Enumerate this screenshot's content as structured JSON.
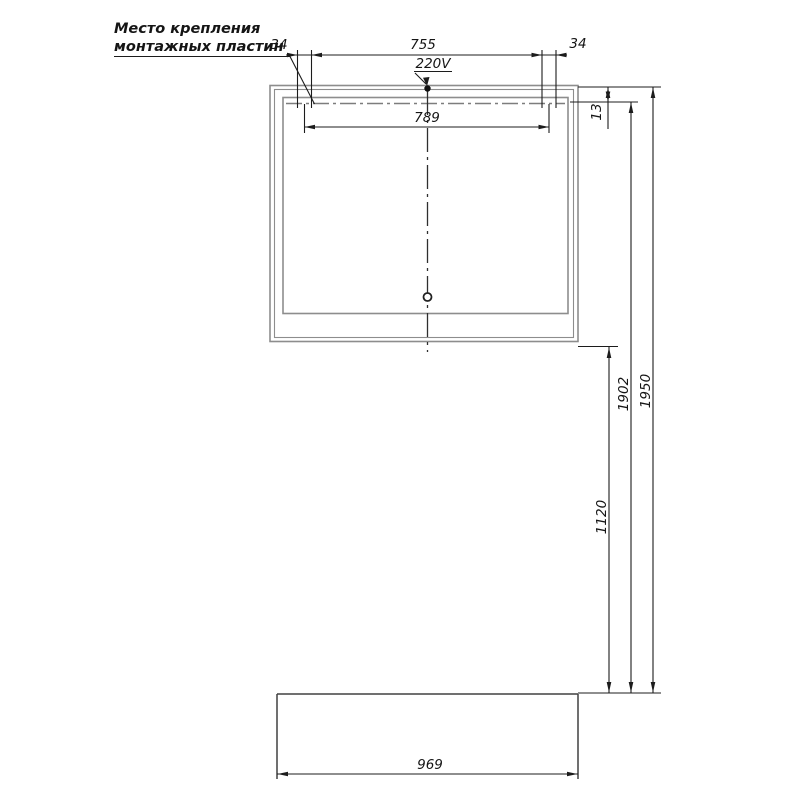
{
  "drawing": {
    "title_semantic": "mirror-installation-dimension-drawing",
    "note": {
      "line1": "Место крепления",
      "line2": "монтажных пластин"
    },
    "dimensions": {
      "plate_width_left": "34",
      "plate_spacing": "755",
      "plate_width_right": "34",
      "power_label": "220V",
      "plate_centers_span": "789",
      "top_offset": "13",
      "mount_line_height": "1902",
      "total_height": "1950",
      "mirror_bottom_height": "1120",
      "cabinet_width": "969"
    },
    "colors": {
      "dimension_lines": "#1c1c1c",
      "mirror_outline": "#8d8d8d",
      "cabinet_outline": "#404040",
      "background": "#ffffff"
    }
  }
}
